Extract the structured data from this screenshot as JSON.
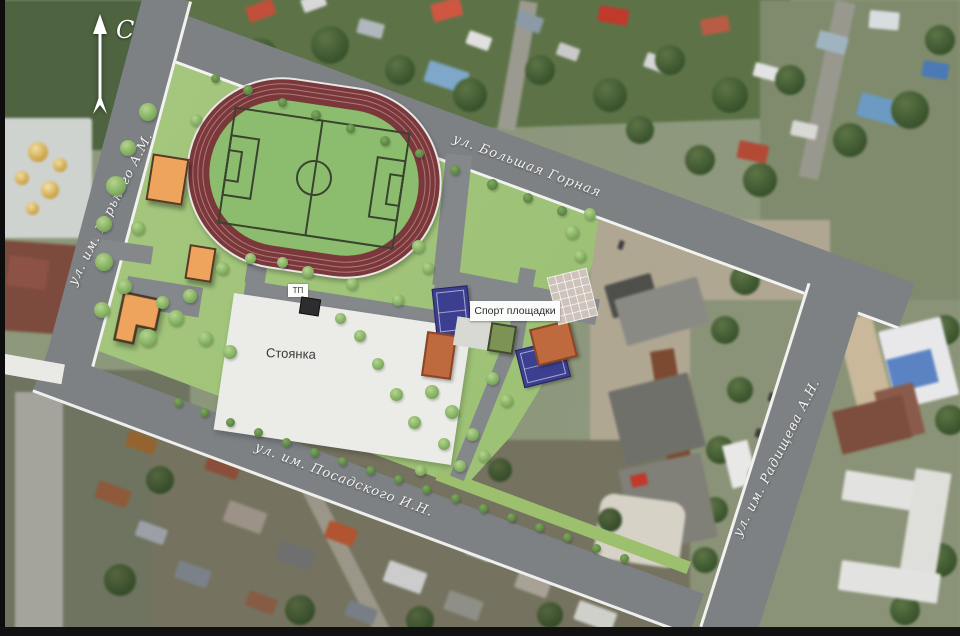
{
  "compass": {
    "north_label": "С"
  },
  "streets": {
    "left": {
      "label": "ул. им. Горького А.М."
    },
    "top": {
      "label": "ул. Большая Горная"
    },
    "bottom": {
      "label": "ул. им. Посадского И.Н."
    },
    "right": {
      "label": "ул. им. Радищева А.Н."
    }
  },
  "areas": {
    "parking_label": "Стоянка",
    "sports_label": "Спорт площадки",
    "substation_label": "ТП"
  },
  "colors": {
    "plan_green": "#a3c57c",
    "road_gray": "#7d8184",
    "sidewalk_white": "#f5f5f5",
    "track_red": "#7b383b",
    "field_green": "#8cbd6e",
    "parking_white": "#ebebe8",
    "building_orange": "#efa45d",
    "court_navy": "#3c3f90",
    "court_orange": "#bf6a3e"
  }
}
